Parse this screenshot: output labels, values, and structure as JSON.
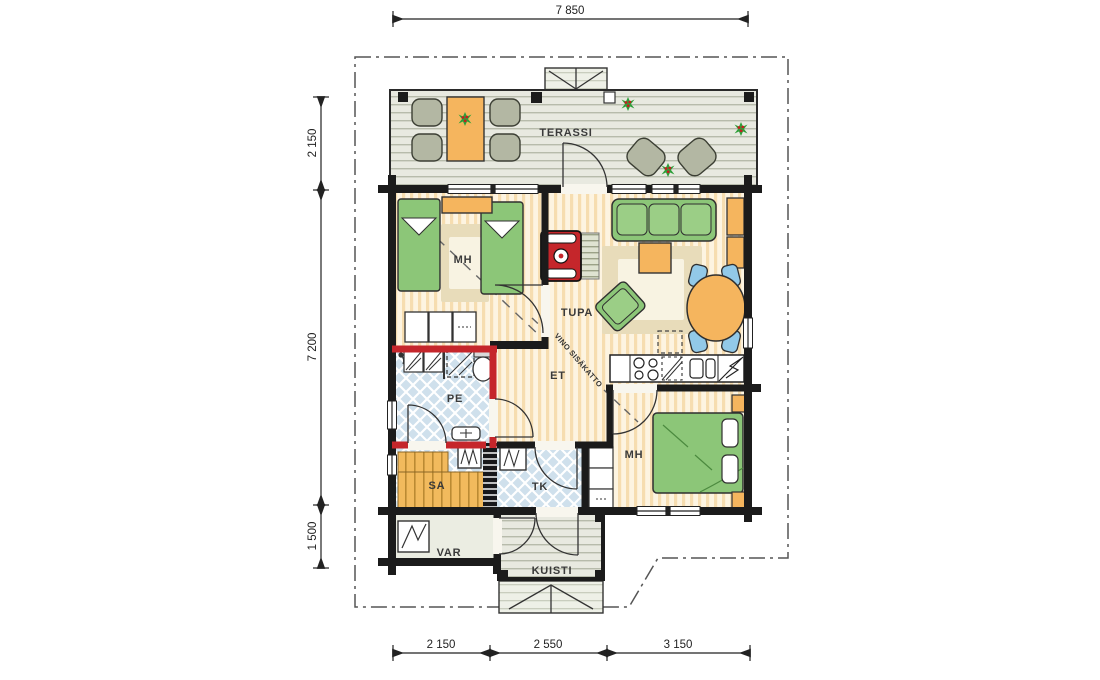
{
  "dimensions": {
    "top": "7 850",
    "left_top": "2 150",
    "left_middle": "7 200",
    "left_bottom": "1 500",
    "bottom_left": "2 150",
    "bottom_middle": "2 550",
    "bottom_right": "3 150"
  },
  "rooms": {
    "terassi": "TERASSI",
    "bedroom1": "MH",
    "livingroom": "TUPA",
    "hall": "ET",
    "bathroom": "PE",
    "sauna": "SA",
    "utility": "TK",
    "bedroom2": "MH",
    "storage": "VAR",
    "porch": "KUISTI"
  },
  "annotations": {
    "sloped_ceiling": "VINO SISÄKATTO"
  },
  "colors": {
    "wall": "#1b1b1b",
    "wet_room_wall": "#c5262b",
    "wood_furniture": "#f5b55e",
    "textile_green": "#8cc678",
    "chair_blue": "#92c9e8",
    "tile_blue": "#cfe0ec",
    "deck": "#e8e9e0",
    "rug": "#e8dcba",
    "plant_green": "#2da03a",
    "plant_berry": "#c51f1f"
  }
}
